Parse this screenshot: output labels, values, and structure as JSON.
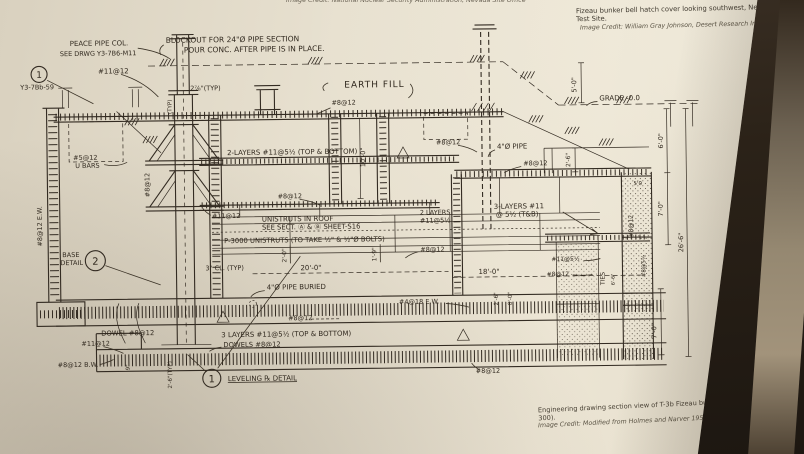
{
  "photo": {
    "top_center_credit": "Image Credit: National Nuclear Security Administration, Nevada Site Office",
    "top_right_caption": "Fizeau bunker bell hatch cover looking southwest, Nevada Test Site.",
    "top_right_credit": "Image Credit: William Gray Johnson, Desert Research Institute",
    "bottom_caption": "Engineering drawing section view of T-3b Fizeau bunker (Building 4-300).",
    "bottom_credit": "Image Credit: Modified from Holmes and Narver 1957",
    "colors": {
      "paper": "#e7e0cf",
      "ink": "#332b22",
      "wall_dark": "#2b2218",
      "wall_light": "#a2937b"
    }
  },
  "drawing": {
    "circled": {
      "c1": "1",
      "c2": "2"
    },
    "labels": {
      "peace1": "PEACE PIPE COL.",
      "peace2": "SEE DRWG Y3-7B6-M11",
      "tag": "Y3-7Bb-59",
      "blockout1": "BLOCKOUT FOR 24\"Ø PIPE SECTION",
      "blockout2": "POUR CONC. AFTER PIPE IS IN PLACE.",
      "bar11_topleft": "#11@12",
      "typ278": "2⅞\"(TYP)",
      "typvert": "(TYP)",
      "earthfill": "EARTH FILL",
      "bar8_earth": "#8@12",
      "grade": "GRADE -0.0",
      "dim5_0": "5'-0\"",
      "ubars1": "#5@12",
      "ubars2": "U BARS",
      "layers2_roof": "2-LAYERS #11@5½ (TOP & BOTTOM)",
      "bar8_col": "#8@12",
      "bar8_slab": "#8@12",
      "dim10_0": "10'-0\"",
      "bar8_r1": "#8@12",
      "pipe4": "4\"Ø PIPE",
      "bar8_r2": "#8@12",
      "dim2_6_roof": "2'-6\"",
      "layers3a": "3-LAYERS #11",
      "layers3b": "@ 5½ (T&B)",
      "layers2a": "2 LAYERS",
      "layers2b": "#11@5½",
      "bar11_mid": "#11@12",
      "uni1": "UNISTRUTS IN ROOF",
      "uni2": "SEE SECT. Ⓐ & Ⓑ SHEET-S16",
      "p3000": "P-3000 UNISTRUTS (TO TAKE ½\" & ½\"Ø BOLTS)",
      "dim2_0": "2'-0\"",
      "dim1_9": "1'-9\"",
      "bar8_mid": "#8@12",
      "cl3": "3\" CL. (TYP)",
      "dim20": "20'-0\"",
      "dim18": "18'-0\"",
      "pipeburied": "4\"Ø PIPE BURIED",
      "bar4_18": "#4@18 E.W.",
      "dim2_6b": "2'-6\"",
      "dim8_0": "8'-0\"",
      "bar8_floor": "#8@12",
      "dowel": "DOWEL #8@12",
      "bar11_bot": "#11@12",
      "bar8_bw": "#8@12 B.W.",
      "layers3_bot": "3 LAYERS #11@5½ (TOP & BOTTOM)",
      "dowels": "DOWELS #8@12",
      "dim9": "9\"",
      "dim2_6_typ": "2'-6\"(TYP)",
      "leveling": "LEVELING ℞ DETAIL",
      "base1": "BASE",
      "base2": "DETAIL",
      "bar8_ew": "#8@12 E.W.",
      "dim6_0": "6'-0\"",
      "dim7_0a": "7'-0\"",
      "dim26_6": "26'-6\"",
      "dim7_0b": "7'-0\"",
      "dim5_0b": "5'0",
      "dim6_6": "6'-6\"",
      "bar11_5_r": "#11@5½",
      "bar8_r3": "#8@12",
      "ties": "TIES",
      "bar8_5_r": "#8@5½",
      "bar8_rwall": "#8@12",
      "bar8_botright": "#8@12"
    }
  }
}
